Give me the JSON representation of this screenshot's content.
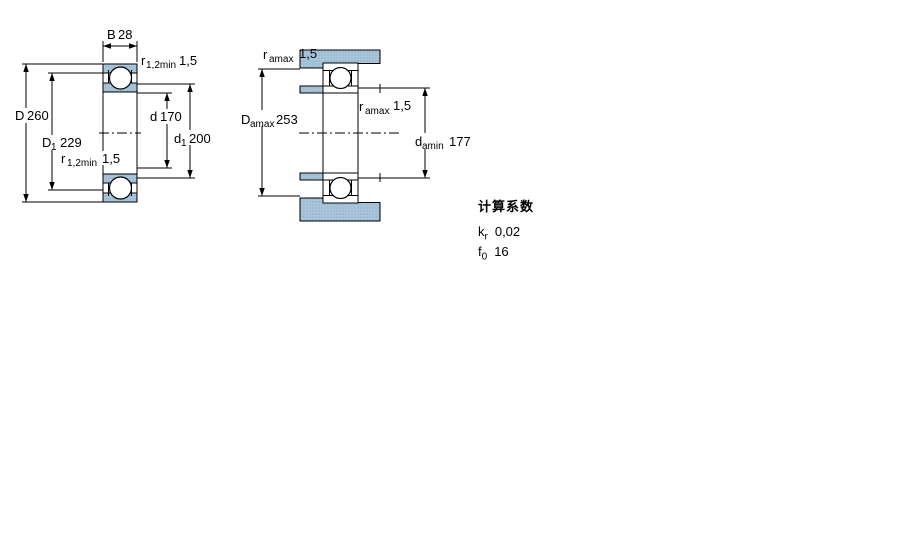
{
  "fig1": {
    "title": "bearing cross section with boundary dimensions",
    "B": {
      "label": "B",
      "value": "28"
    },
    "D": {
      "label": "D",
      "value": "260"
    },
    "D1": {
      "label": "D",
      "sub": "1",
      "value": "229"
    },
    "d": {
      "label": "d",
      "value": "170"
    },
    "d1": {
      "label": "d",
      "sub": "1",
      "value": "200"
    },
    "r_top": {
      "label": "r",
      "sub": "1,2min",
      "value": "1,5"
    },
    "r_mid": {
      "label": "r",
      "sub": "1,2min",
      "value": "1,5"
    }
  },
  "fig2": {
    "title": "mounting / abutment dimensions",
    "r_a_top": {
      "label": "r",
      "sub": "amax",
      "value": "1,5"
    },
    "D_a": {
      "label": "D",
      "sub": "amax",
      "value": "253"
    },
    "r_a_right": {
      "label": "r",
      "sub": "amax",
      "value": "1,5"
    },
    "d_a": {
      "label": "d",
      "sub": "amin",
      "value": "177"
    }
  },
  "calculation_factors": {
    "title": "计算系数",
    "rows": [
      {
        "label": "k",
        "sub": "r",
        "value": "0,02"
      },
      {
        "label": "f",
        "sub": "0",
        "value": "16"
      }
    ]
  },
  "colors": {
    "section_fill": "#a9c6db",
    "section_dot": "#7fa7c2",
    "line": "#000000",
    "background": "#ffffff"
  }
}
